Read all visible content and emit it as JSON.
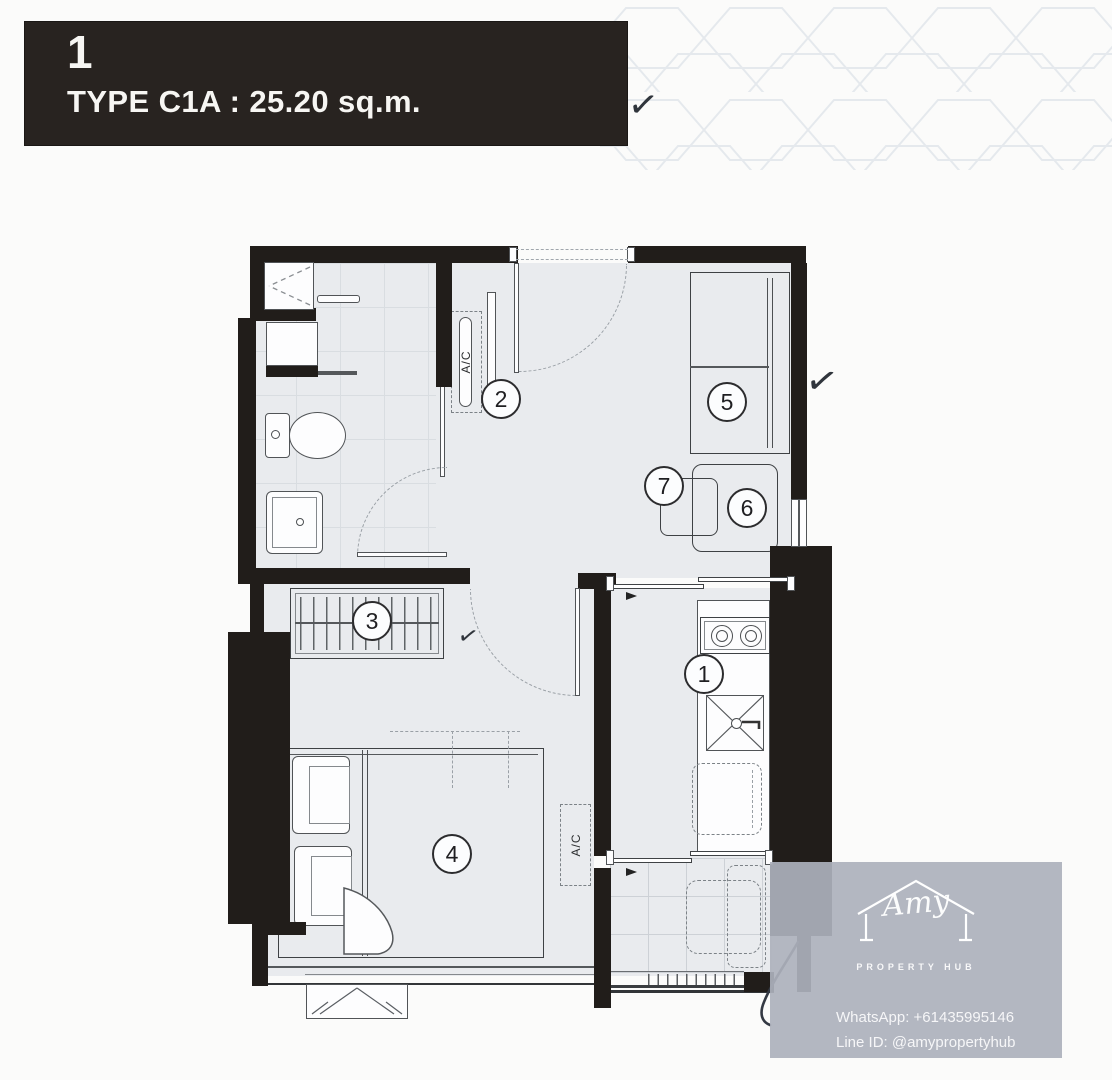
{
  "title_block": {
    "unit_number": "1",
    "type_label": "TYPE C1A : 25.20 sq.m."
  },
  "floor_plan": {
    "room_markers": [
      "1",
      "2",
      "3",
      "4",
      "5",
      "6",
      "7"
    ],
    "ac_unit_label": "A/C",
    "checkmark_glyph": "✓"
  },
  "watermark": {
    "brand_name": "Amy",
    "brand_subtitle": "PROPERTY HUB",
    "whatsapp": "WhatsApp: +61435995146",
    "line_id": "Line ID: @amypropertyhub"
  },
  "colors": {
    "wall": "#211d1a",
    "floor": "#e9ebee",
    "title_background": "#282320",
    "watermark_background": "rgba(172,177,188,0.92)",
    "pattern_stroke": "#e2e7ec"
  }
}
